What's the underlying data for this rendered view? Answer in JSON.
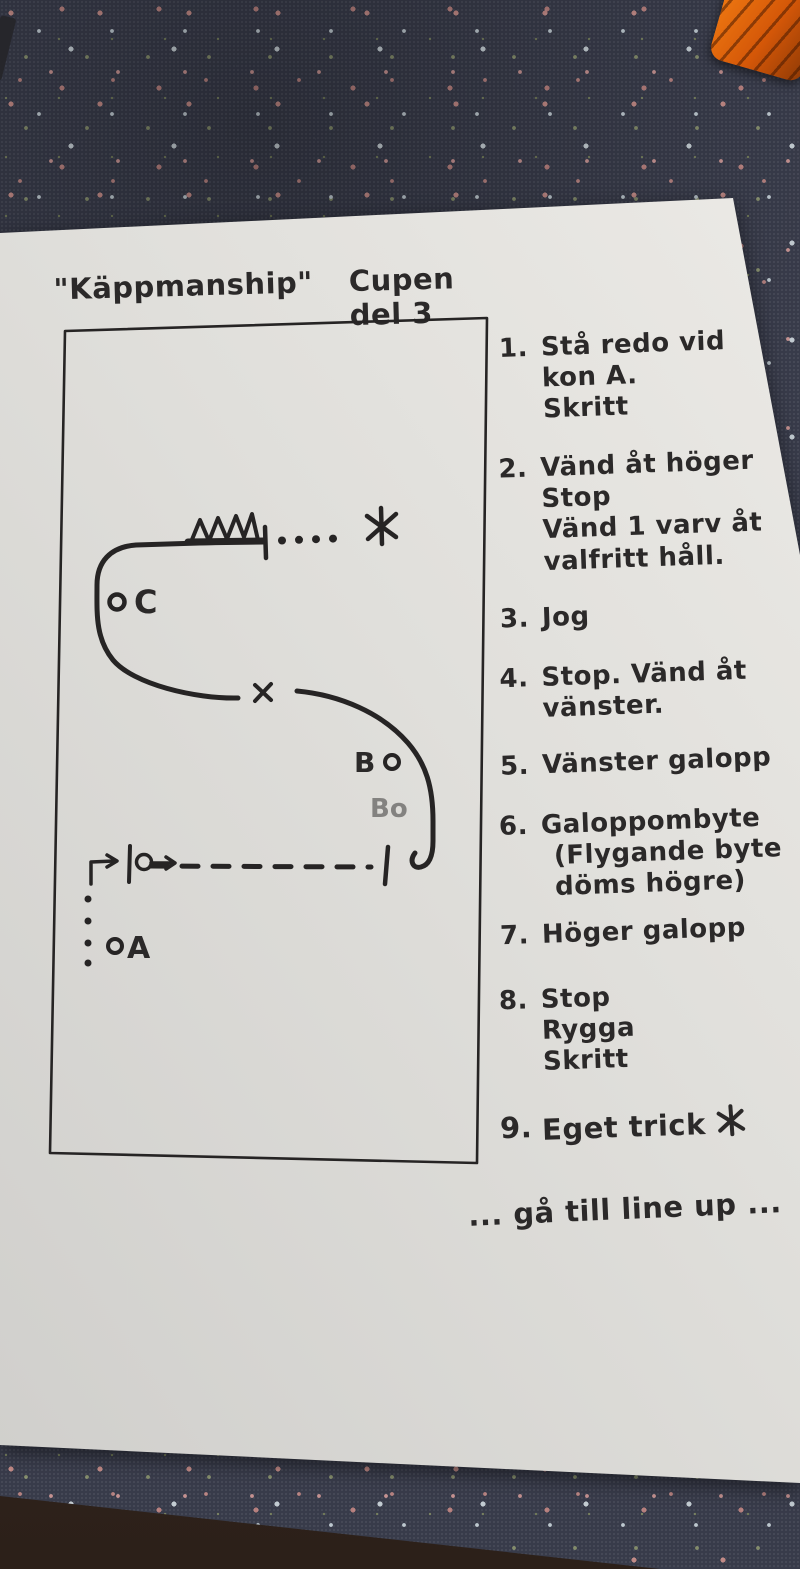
{
  "title": {
    "name_quoted": "\"Käppmanship\"",
    "subtitle": "Cupen del 3"
  },
  "diagram": {
    "marker_c": "C",
    "marker_b": "B",
    "marker_a": "A",
    "ghost_label": "Bo",
    "icons": {
      "star": "✶",
      "cross": "×",
      "jump": "zigzag-jump-symbol",
      "spin": "loop-turn-arrow"
    }
  },
  "instructions": [
    {
      "num": "1.",
      "lines": [
        "Stå redo vid",
        "kon A.",
        "Skritt"
      ]
    },
    {
      "num": "2.",
      "lines": [
        "Vänd åt höger",
        "Stop",
        "Vänd 1 varv åt",
        "valfritt håll."
      ]
    },
    {
      "num": "3.",
      "lines": [
        "Jog"
      ]
    },
    {
      "num": "4.",
      "lines": [
        "Stop. Vänd åt",
        "vänster."
      ]
    },
    {
      "num": "5.",
      "lines": [
        "Vänster galopp"
      ]
    },
    {
      "num": "6.",
      "lines": [
        "Galoppombyte",
        "(Flygande byte",
        "döms högre)"
      ]
    },
    {
      "num": "7.",
      "lines": [
        "Höger galopp"
      ]
    },
    {
      "num": "8.",
      "lines": [
        "Stop",
        "Rygga",
        "Skritt"
      ]
    },
    {
      "num": "9.",
      "lines": [
        "Eget trick"
      ]
    }
  ],
  "footer": "... gå till line up ..."
}
